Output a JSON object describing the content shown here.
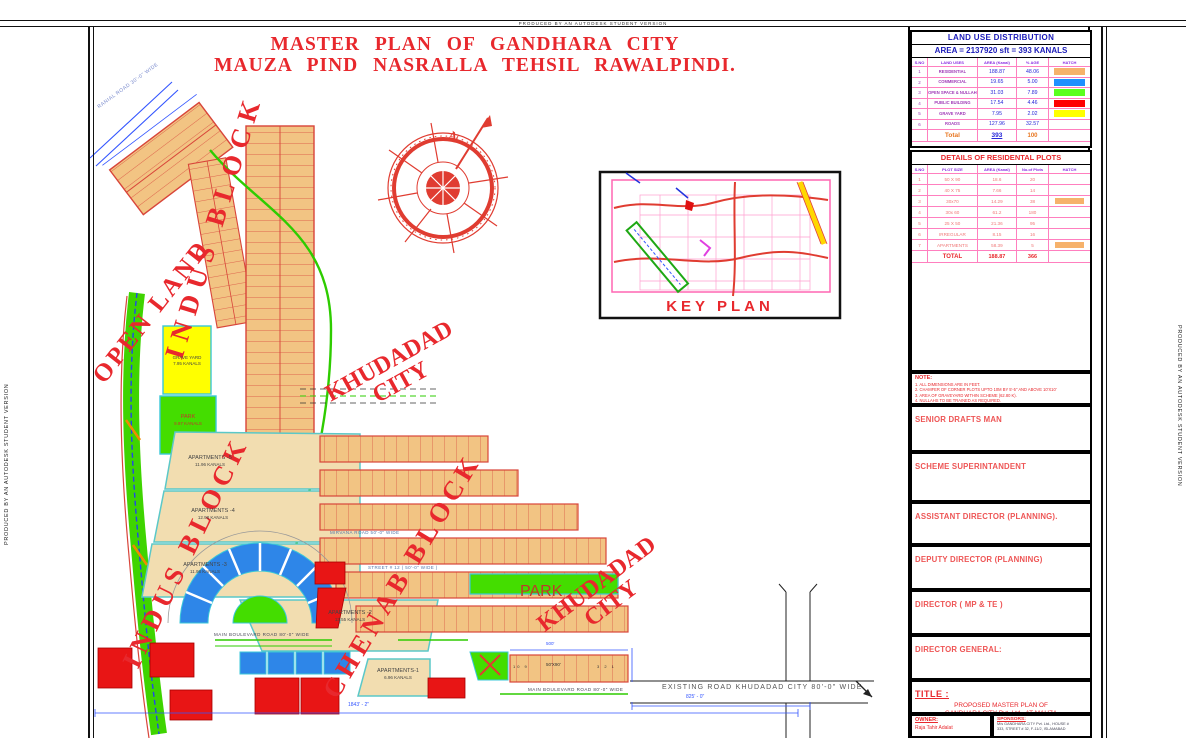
{
  "edge": {
    "autodesk": "PRODUCED BY AN AUTODESK STUDENT VERSION"
  },
  "title": {
    "line1": "MASTER  PLAN  OF  GANDHARA  CITY",
    "line2": "MAUZA  PIND  NASRALLA  TEHSIL  RAWALPINDI."
  },
  "compass": {
    "north": "N"
  },
  "key_plan": {
    "label": "KEY PLAN"
  },
  "zones": {
    "open_land": "OPEN LAND",
    "indus_block_top": "INDUS BLOCK",
    "indus_block_bottom": "INDUS BLOCK",
    "khudadad_top_1": "KHUDADAD",
    "khudadad_top_2": "CITY",
    "khudadad_bottom_1": "KHUDADAD",
    "khudadad_bottom_2": "CITY",
    "chenab_block": "CHENAB BLOCK"
  },
  "features": {
    "grave_yard_1": "GRAVE YARD",
    "grave_yard_2": "7.95 KANALS",
    "park_1": "PARK",
    "park_2": "9.97 KANALS",
    "park_strip": "PARK",
    "apartments": [
      {
        "name": "APARTMENTS -5",
        "area": "11.96 KANALS"
      },
      {
        "name": "APARTMENTS -4",
        "area": "12.98 KANALS"
      },
      {
        "name": "APARTMENTS -3",
        "area": "11.98 KANALS"
      },
      {
        "name": "APARTMENTS -2",
        "area": "13.55 KANALS"
      },
      {
        "name": "APARTMENTS-1",
        "area": "6.96 KANALS"
      }
    ],
    "plot_strip": {
      "left": "10  9",
      "label": "50'X90'",
      "right": "3  2  1"
    }
  },
  "roads": {
    "ranial": "RANIAL ROAD 30'-0\" WIDE",
    "main_blvd": "MAIN BOULEVARD  ROAD 80'-0\"  WIDE",
    "main_blvd2": "MAIN BOULEVARD  ROAD 80'-0\"  WIDE",
    "existing": "EXISTING  ROAD  KHUDADAD CITY   80'-0\"  WIDE",
    "mirvana": "MIRVANA ROAD  50'-0\"  WIDE",
    "street12": "STREET # 12 ( 50'-0\" WIDE )",
    "dim_1843": "1843' - 2\"",
    "dim_825": "825' - 0\"",
    "dim_500": "500'"
  },
  "land_use": {
    "title": "LAND USE DISTRIBUTION",
    "area_line": "AREA  =  2137920 sft   =   393 KANALS",
    "columns": [
      "S.NO",
      "LAND USES",
      "AREA (Kanal)",
      "% AGE",
      "HATCH"
    ],
    "rows": [
      {
        "no": "1",
        "use": "RESIDENTIAL",
        "area": "188.87",
        "pct": "48.06",
        "hatch": "background:#F6B26B"
      },
      {
        "no": "2",
        "use": "COMMERCIAL",
        "area": "19.65",
        "pct": "5.00",
        "hatch": "background:#1E90FF"
      },
      {
        "no": "3",
        "use": "OPEN SPACE & NULLAH",
        "area": "31.03",
        "pct": "7.89",
        "hatch": "background:#5BFF1E"
      },
      {
        "no": "4",
        "use": "PUBLIC BUILDING",
        "area": "17.54",
        "pct": "4.46",
        "hatch": "background:#FF0000"
      },
      {
        "no": "5",
        "use": "GRAVE YARD",
        "area": "7.95",
        "pct": "2.02",
        "hatch": "background:#FFFF00"
      },
      {
        "no": "6",
        "use": "ROADS",
        "area": "127.96",
        "pct": "32.57",
        "hatch": ""
      }
    ],
    "total": {
      "label": "Total",
      "area": "393",
      "pct": "100"
    }
  },
  "plots": {
    "title": "DETAILS OF RESIDENTAL PLOTS",
    "columns": [
      "S.NO",
      "PLOT SIZE",
      "AREA (Kanal)",
      "No.of Plots",
      "HATCH"
    ],
    "rows": [
      {
        "no": "1",
        "size": "50 X 90",
        "area": "18.6",
        "count": "20",
        "hatch": ""
      },
      {
        "no": "2",
        "size": "40 X 75",
        "area": "7.66",
        "count": "14",
        "hatch": ""
      },
      {
        "no": "3",
        "size": "30x70",
        "area": "14.29",
        "count": "38",
        "hatch": "background:#F6B26B"
      },
      {
        "no": "4",
        "size": "30x 60",
        "area": "61.2",
        "count": "180",
        "hatch": ""
      },
      {
        "no": "5",
        "size": "25 X 50",
        "area": "21.36",
        "count": "95",
        "hatch": ""
      },
      {
        "no": "6",
        "size": "IRREGULAR",
        "area": "8.15",
        "count": "16",
        "hatch": ""
      },
      {
        "no": "7",
        "size": "APARTMENTS",
        "area": "58.39",
        "count": "5",
        "hatch": "background:#F6B26B"
      }
    ],
    "total": {
      "label": "TOTAL",
      "area": "188.87",
      "count": "366"
    }
  },
  "note": {
    "title": "NOTE:",
    "line1": "1. ALL DIMENSIONS ARE IN FEET.",
    "line2": "2. CHAMFER OF CORNER PLOTS UPTO 10M BY 5'-5\" AND ABOVE 10'X10'",
    "line3": "3. AREA OF GRAVEYARD WITHIN SCHEME (62.80 K).",
    "line4": "4. NULLAHS TO BE TRAINED AS REQUIRED."
  },
  "signatures": [
    {
      "label": "SENIOR DRAFTS MAN"
    },
    {
      "label": "SCHEME SUPERINTANDENT"
    },
    {
      "label": "ASSISTANT DIRECTOR (PLANNING)."
    },
    {
      "label": "DEPUTY DIRECTOR (PLANNING)"
    },
    {
      "label": "DIRECTOR  ( MP & TE )"
    },
    {
      "label": "DIRECTOR GENERAL:"
    }
  ],
  "title_block": {
    "label": "TITLE :",
    "line1": "PROPOSED MASTER PLAN OF",
    "line2": "GANDHARA CITY Pvt. Ltd., AT MAUZA",
    "line3": "NASRALLAH , TEHSIL  RAWALPINDI."
  },
  "owner": {
    "label": "OWNER:",
    "name": "Raja Tahir Adalat"
  },
  "sponsors": {
    "label": "SPONSORS:",
    "line1": "M/s GANDHARA CITY Pvt. Ltd., HOUSE #",
    "line2": "333, STREET # 32, F-11/2, ISLAMABAD"
  },
  "colors": {
    "accent_red": "#E8282D",
    "navy": "#1A1AB8",
    "grid_pink": "#FF7FBF",
    "plot_orange": "#F2C483",
    "commercial_blue": "#2E86E8",
    "open_green": "#44DD00",
    "public_red": "#EE1111",
    "grave_yellow": "#FFFF00",
    "dim_blue": "#3355FF"
  }
}
